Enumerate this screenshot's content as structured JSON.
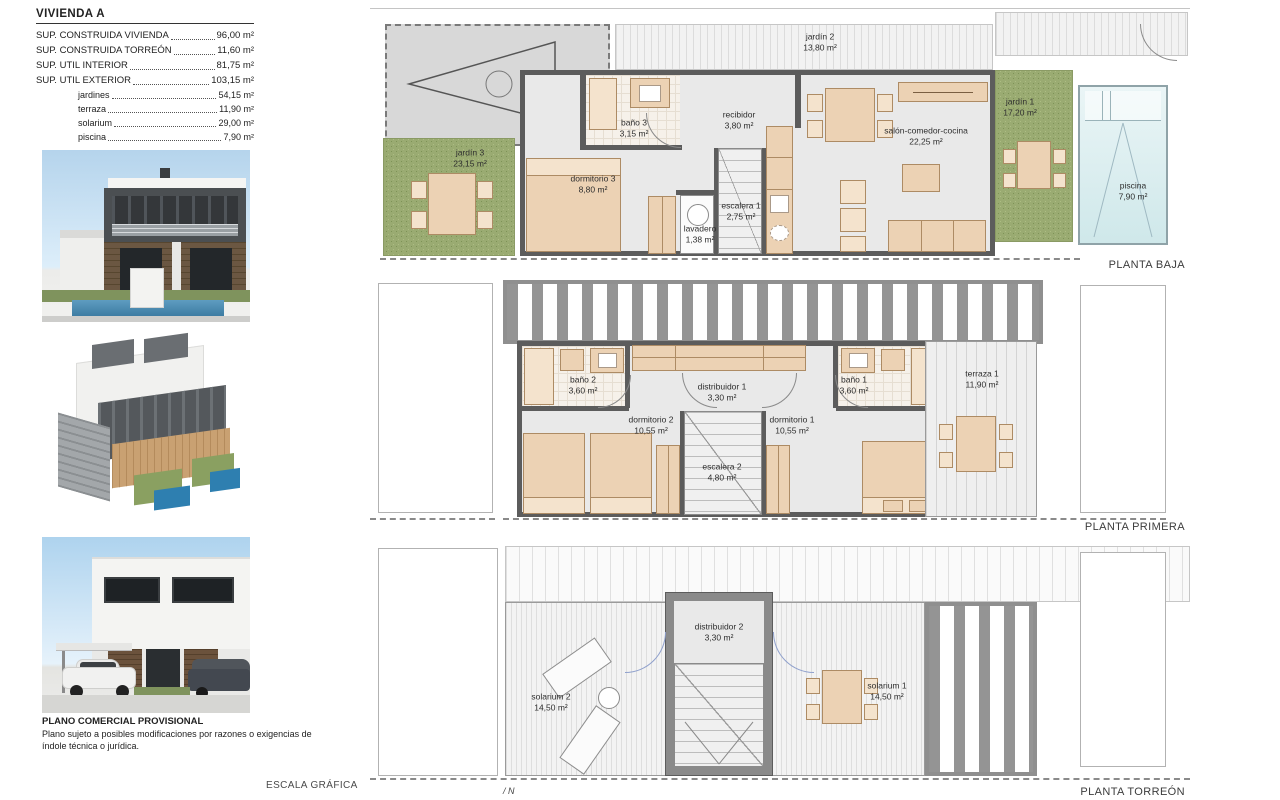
{
  "document": {
    "title": "VIVIENDA A",
    "specs": [
      {
        "label": "SUP. CONSTRUIDA VIVIENDA",
        "value": "96,00 m²"
      },
      {
        "label": "SUP. CONSTRUIDA TORREÓN",
        "value": "11,60 m²"
      },
      {
        "label": "SUP. UTIL INTERIOR",
        "value": "81,75 m²"
      },
      {
        "label": "SUP. UTIL EXTERIOR",
        "value": "103,15 m²"
      }
    ],
    "sub_specs": [
      {
        "label": "jardines",
        "value": "54,15 m²"
      },
      {
        "label": "terraza",
        "value": "11,90 m²"
      },
      {
        "label": "solarium",
        "value": "29,00 m²"
      },
      {
        "label": "piscina",
        "value": "7,90 m²"
      }
    ]
  },
  "plans": {
    "baja": {
      "title": "PLANTA BAJA",
      "rooms": [
        {
          "name": "jardín 2",
          "area": "13,80 m²"
        },
        {
          "name": "jardín 3",
          "area": "23,15 m²"
        },
        {
          "name": "baño 3",
          "area": "3,15 m²"
        },
        {
          "name": "recibidor",
          "area": "3,80 m²"
        },
        {
          "name": "dormitorio 3",
          "area": "8,80 m²"
        },
        {
          "name": "lavadero",
          "area": "1,38 m²"
        },
        {
          "name": "escalera 1",
          "area": "2,75 m²"
        },
        {
          "name": "salón-comedor-cocina",
          "area": "22,25 m²"
        },
        {
          "name": "jardín 1",
          "area": "17,20 m²"
        },
        {
          "name": "piscina",
          "area": "7,90 m²"
        }
      ]
    },
    "primera": {
      "title": "PLANTA PRIMERA",
      "rooms": [
        {
          "name": "baño 2",
          "area": "3,60 m²"
        },
        {
          "name": "distribuidor 1",
          "area": "3,30 m²"
        },
        {
          "name": "baño 1",
          "area": "3,60 m²"
        },
        {
          "name": "dormitorio 2",
          "area": "10,55 m²"
        },
        {
          "name": "dormitorio 1",
          "area": "10,55 m²"
        },
        {
          "name": "escalera 2",
          "area": "4,80 m²"
        },
        {
          "name": "terraza 1",
          "area": "11,90 m²"
        }
      ]
    },
    "torreon": {
      "title": "PLANTA TORREÓN",
      "rooms": [
        {
          "name": "solarium 2",
          "area": "14,50 m²"
        },
        {
          "name": "distribuidor 2",
          "area": "3,30 m²"
        },
        {
          "name": "solarium 1",
          "area": "14,50 m²"
        }
      ]
    }
  },
  "footer": {
    "disclaimer_title": "PLANO COMERCIAL PROVISIONAL",
    "disclaimer_body": "Plano sujeto a posibles modificaciones por razones o exigencias de índole técnica o jurídica.",
    "escala_label": "ESCALA GRÁFICA",
    "north_label": "N"
  },
  "colors": {
    "wall": "#5c5c5c",
    "floor": "#e9e9e9",
    "furniture": "#ecd2b4",
    "grass": "#9aab72",
    "pool": "#d8ecee",
    "sky": "#b5d4ec"
  }
}
